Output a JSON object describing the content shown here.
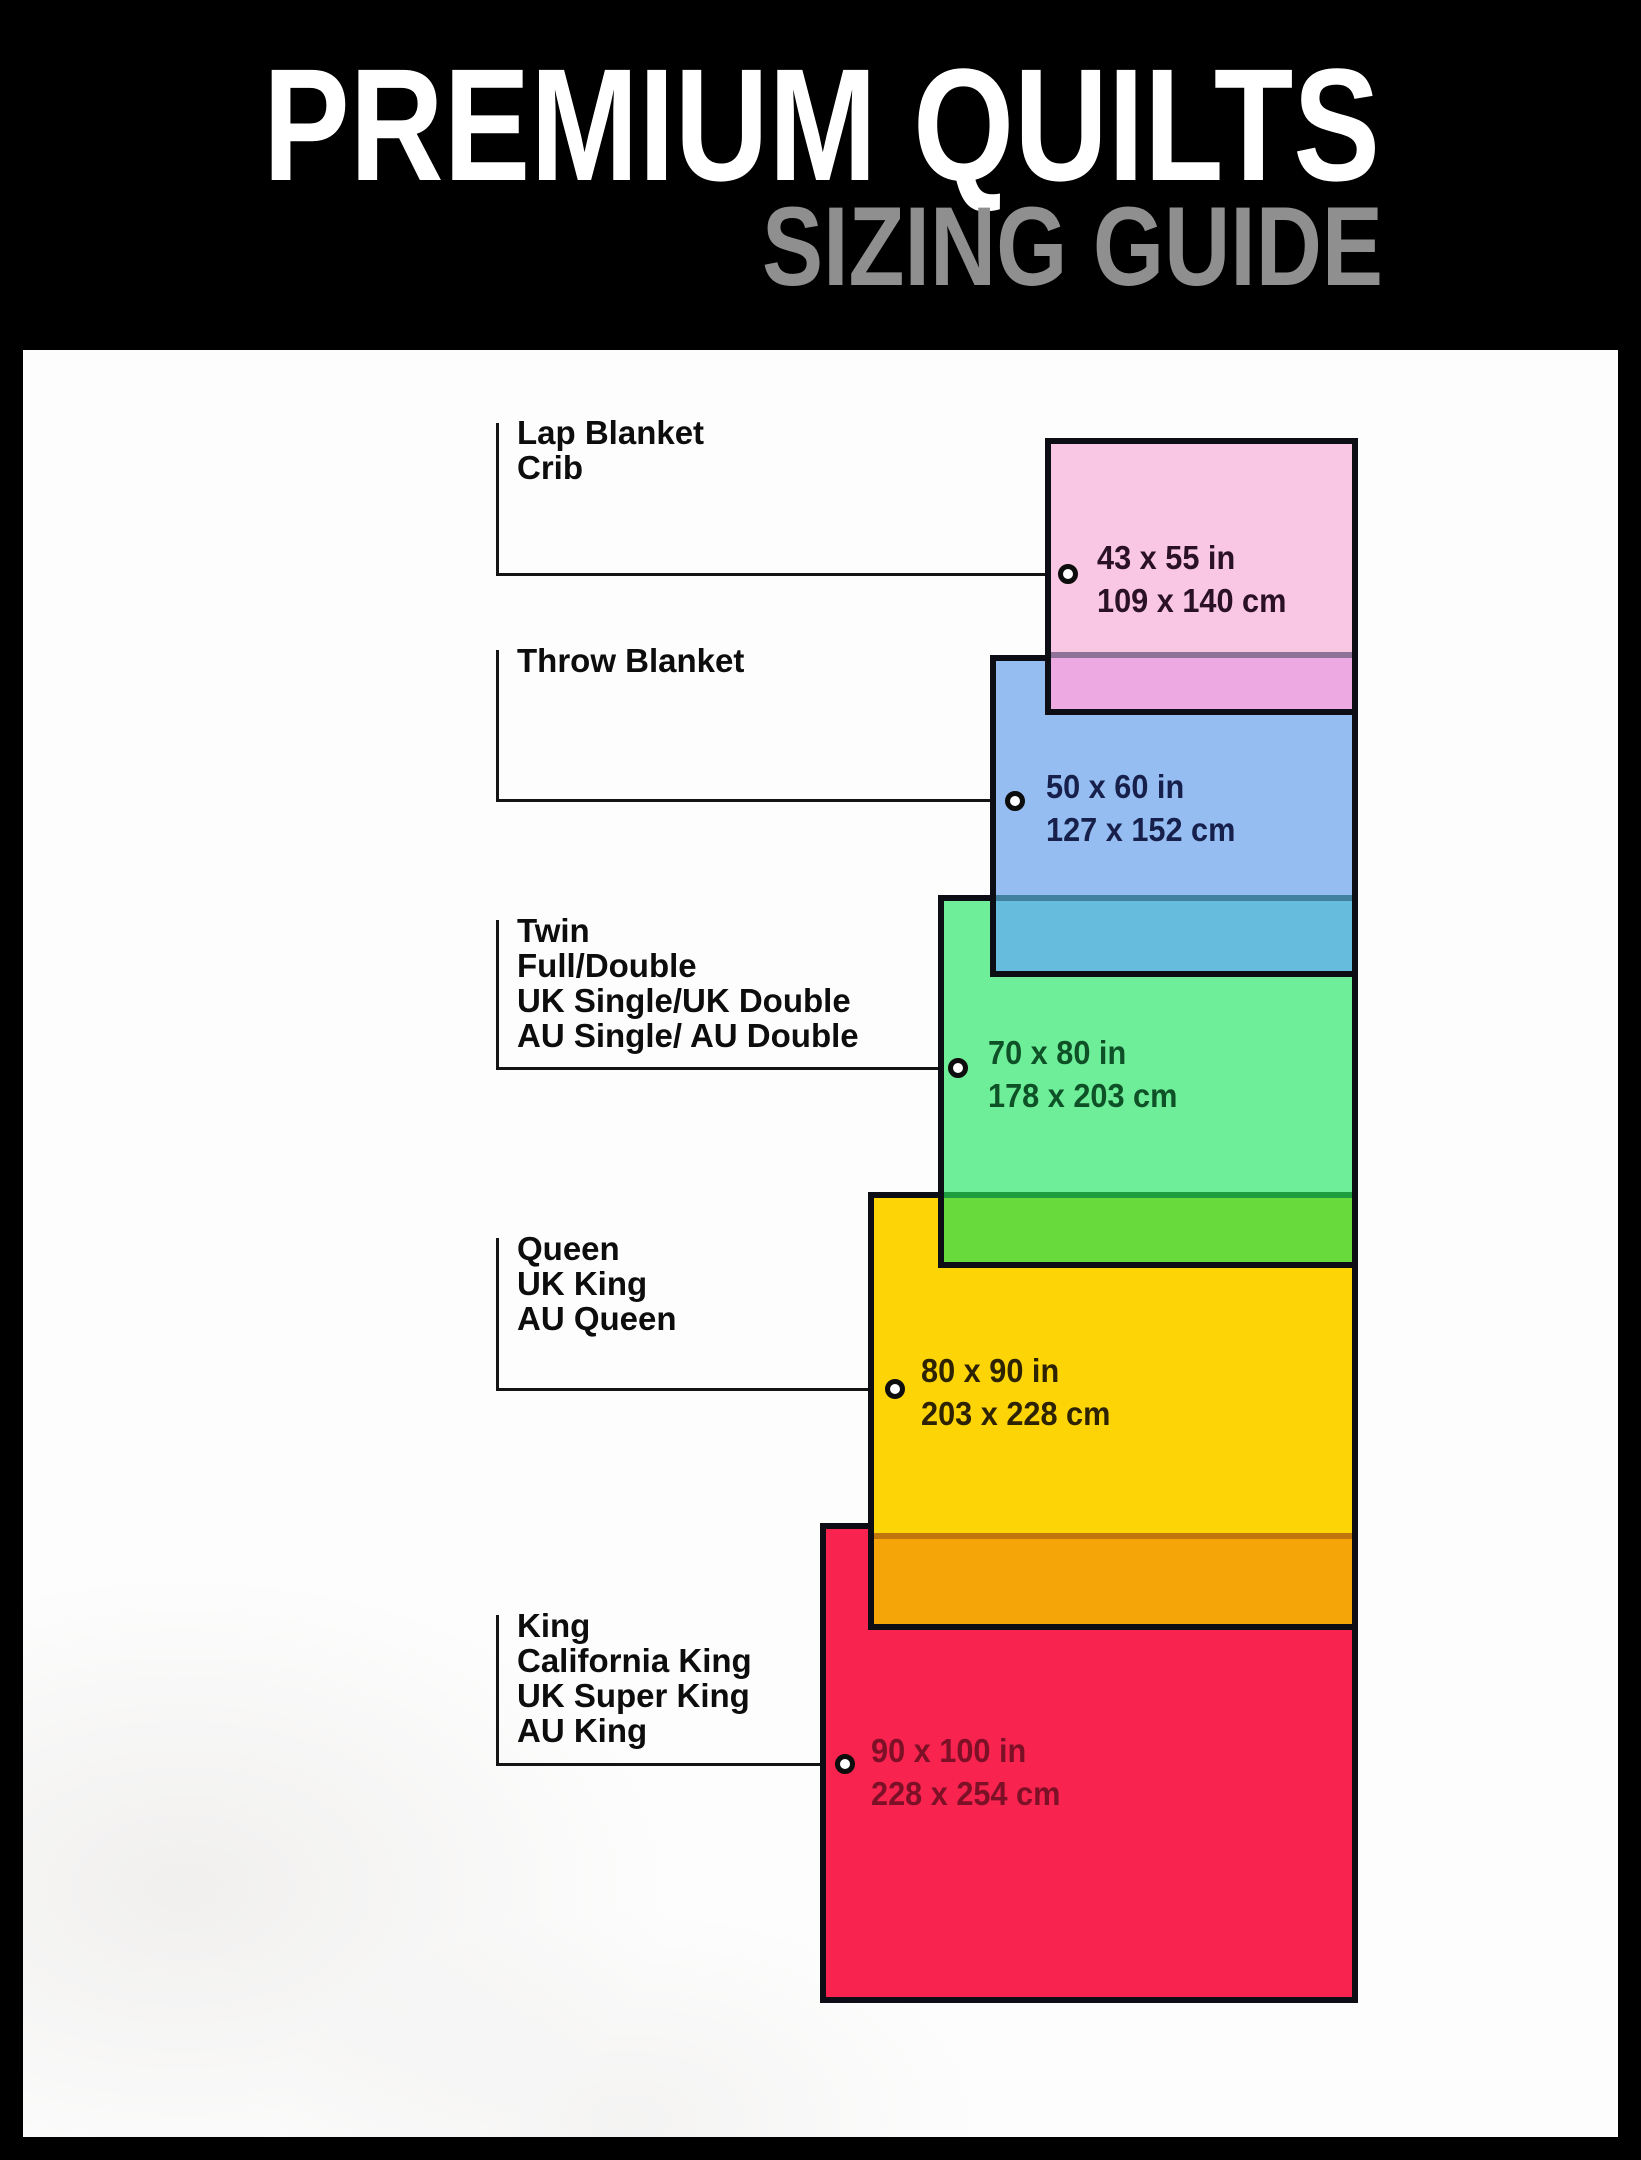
{
  "header": {
    "title": "PREMIUM QUILTS",
    "subtitle": "SIZING GUIDE",
    "title_color": "#ffffff",
    "subtitle_color": "#8f8f8f",
    "band_color": "#000000"
  },
  "sizes": [
    {
      "names": [
        "Lap Blanket",
        "Crib"
      ],
      "inches": "43 x 55 in",
      "cm": "109 x 140 cm",
      "fill": "#f9c6e3",
      "overlap_fill": "#eda9e2",
      "overlap_line": "#8e7298",
      "text_color": "#2a1126"
    },
    {
      "names": [
        "Throw Blanket"
      ],
      "inches": "50 x 60 in",
      "cm": "127 x 152 cm",
      "fill": "#95bdf2",
      "overlap_fill": "#65bcdc",
      "overlap_line": "#41809e",
      "text_color": "#16204a"
    },
    {
      "names": [
        "Twin",
        "Full/Double",
        "UK Single/UK Double",
        "AU Single/ AU Double"
      ],
      "inches": "70 x 80 in",
      "cm": "178 x 203 cm",
      "fill": "#6fee99",
      "overlap_fill": "#69da3b",
      "overlap_line": "#1f9c40",
      "text_color": "#0e5127"
    },
    {
      "names": [
        "Queen",
        "UK King",
        "AU Queen"
      ],
      "inches": "80 x 90 in",
      "cm": "203 x 228 cm",
      "fill": "#fdd506",
      "overlap_fill": "#f6a508",
      "overlap_line": "#c0760c",
      "text_color": "#2e2301"
    },
    {
      "names": [
        "King",
        "California King",
        "UK Super King",
        "AU King"
      ],
      "inches": "90 x 100 in",
      "cm": "228 x 254 cm",
      "fill": "#f8234e",
      "overlap_fill": null,
      "overlap_line": null,
      "text_color": "#7c1027"
    }
  ]
}
